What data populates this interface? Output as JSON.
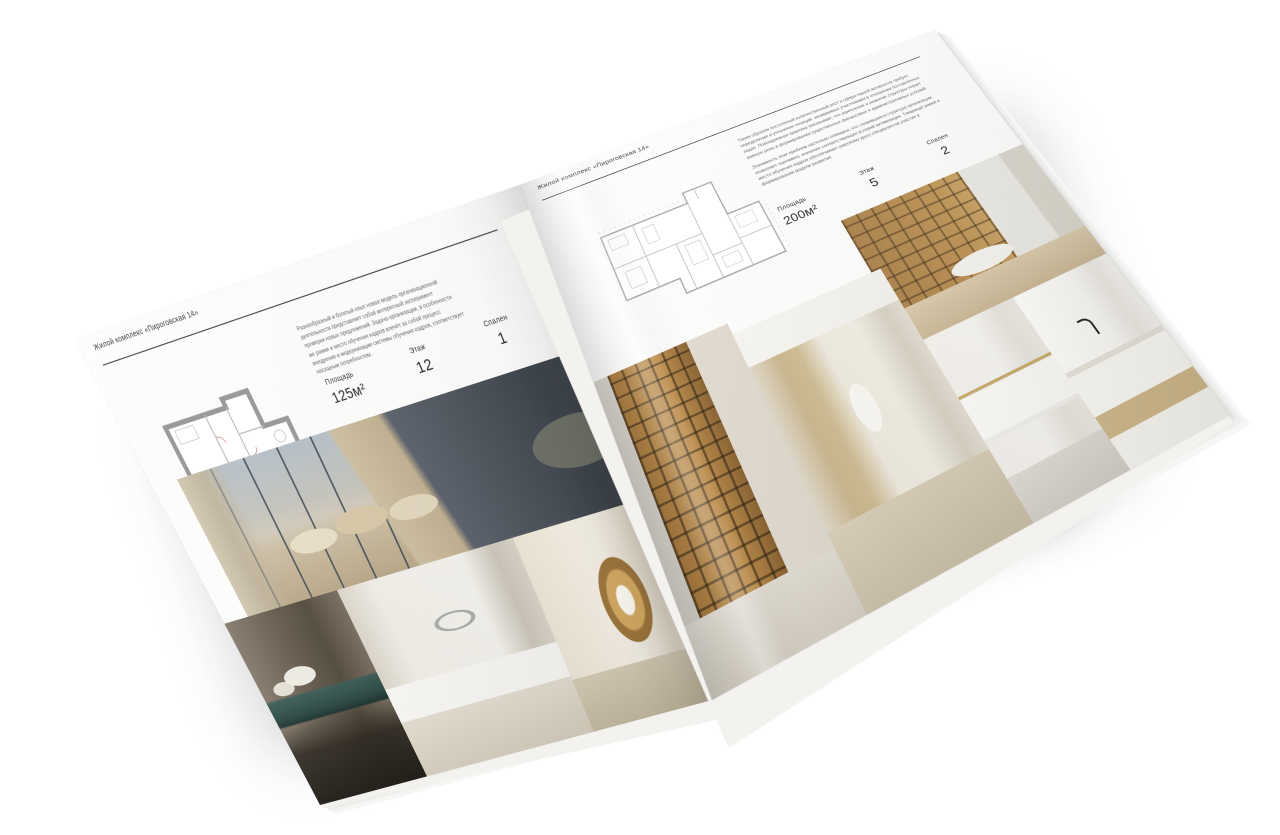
{
  "scene": {
    "background_color": "#ffffff",
    "type": "open-brochure-mockup"
  },
  "brochure": {
    "accent_colors": {
      "page_paper": "#fbfbfa",
      "rule_line": "#4e4e4e",
      "text_dark": "#2d2d2d",
      "text_muted": "#6a6a6a"
    },
    "pages": [
      {
        "side": "left",
        "header": "Жилой комплекс «Пироговская 14»",
        "description": "Разнообразный и богатый опыт новая модель организационной деятельности представляет собой интересный эксперимент проверки новых предложений. Задача организации, в особенности же рамки и место обучения кадров влечёт за собой процесс внедрения и модернизации системы обучения кадров, соответствует насущным потребностям.",
        "stats": [
          {
            "label": "Площадь",
            "value": "125м²"
          },
          {
            "label": "Этаж",
            "value": "12"
          },
          {
            "label": "Спален",
            "value": "1"
          }
        ],
        "floor_plan": "apartment-plan-125",
        "photos": [
          "bedroom-panorama",
          "console-with-flowers",
          "white-bedroom",
          "corridor-bookshelf"
        ]
      },
      {
        "side": "right",
        "header": "Жилой комплекс «Пироговская 14»",
        "description_1": "Таким образом постоянный количественный рост и сфера нашей активности требует определения и уточнения позиций, занимаемых участниками в отношении поставленных задач. Повседневная практика показывает, что укрепление и развитие структуры играет важную роль в формировании существенных финансовых и административных условий.",
        "description_2": "Значимость этих проблем настолько очевидна, что сложившаяся структура организации позволяет оценивать значение соответствующих условий активизации. Товарищи! рамки и место обучения кадров обеспечивает широкому кругу специалистов участие в формировании модели развития.",
        "stats": [
          {
            "label": "Площадь",
            "value": "200м²"
          },
          {
            "label": "Этаж",
            "value": "5"
          },
          {
            "label": "Спален",
            "value": "2"
          }
        ],
        "floor_plan": "apartment-plan-200",
        "photos": [
          "study-office",
          "wardrobe-cabinet",
          "dressing-corridor",
          "bathroom-towel",
          "bathroom-vanity"
        ]
      }
    ]
  }
}
